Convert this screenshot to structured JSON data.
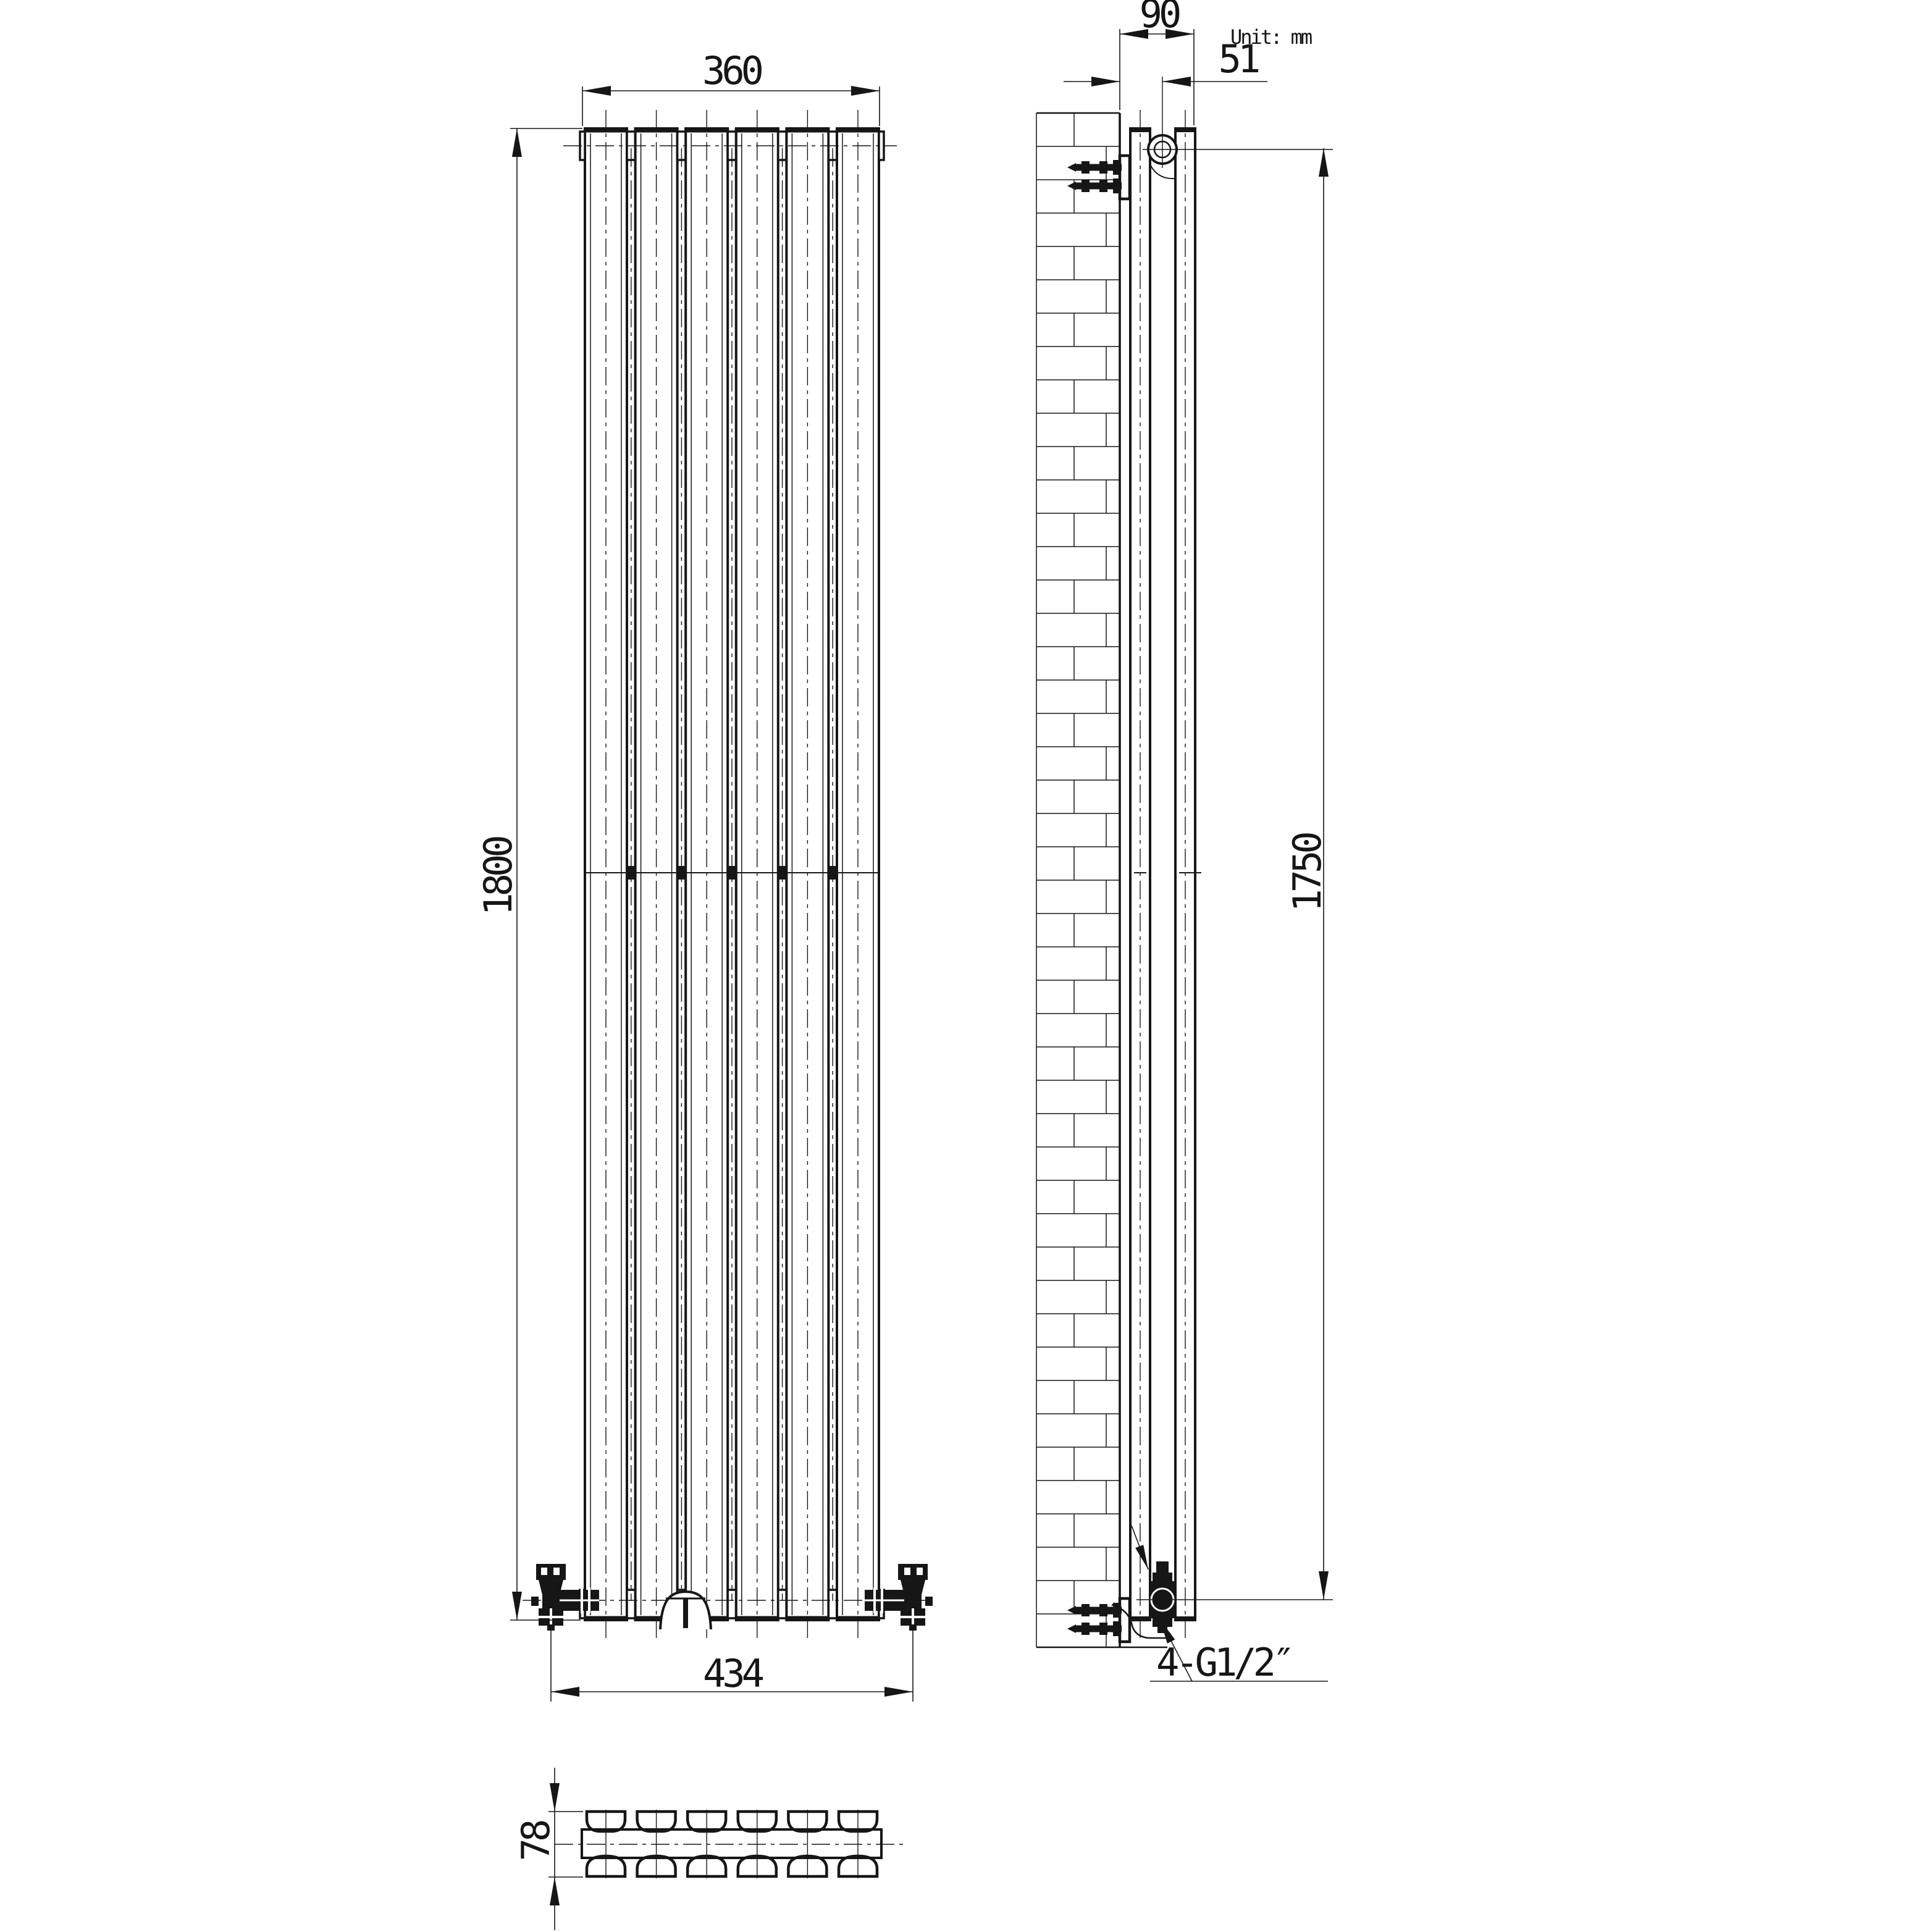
{
  "unit_note": "Unit: mm",
  "colors": {
    "line": "#161616",
    "background": "#ffffff"
  },
  "views": {
    "front": {
      "dim_width_top": "360",
      "dim_height": "1800",
      "dim_width_bottom": "434"
    },
    "side": {
      "dim_depth": "90",
      "dim_wall_to_pipe": "51",
      "dim_bracket_span": "1750",
      "connection_label": "4-G1/2″"
    },
    "section": {
      "dim_depth": "78"
    }
  }
}
